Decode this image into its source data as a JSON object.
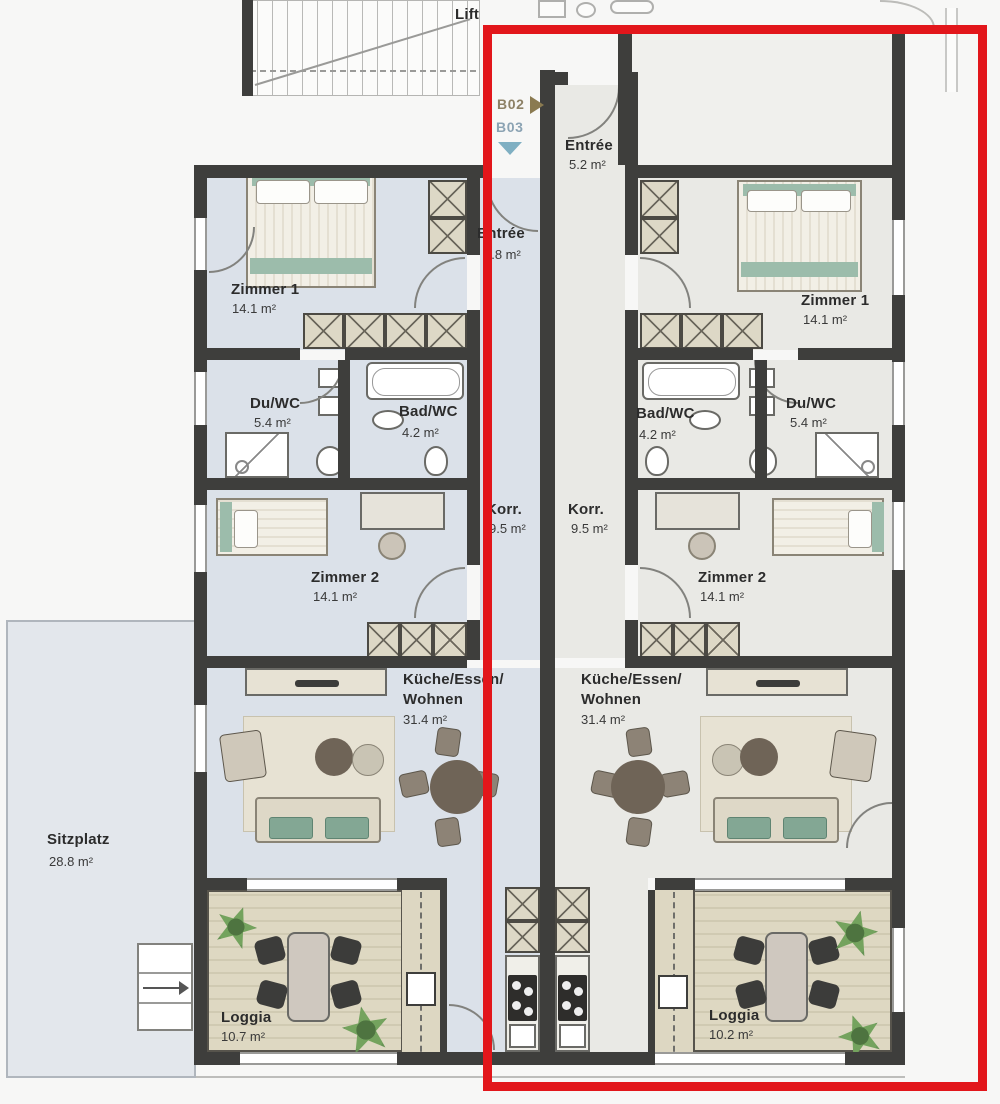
{
  "labels": {
    "lift": "Lift"
  },
  "markers": {
    "b02": "B02",
    "b03": "B03"
  },
  "outdoor": {
    "sitzplatz_name": "Sitzplatz",
    "sitzplatz_area": "28.8 m²"
  },
  "apartment_left": {
    "entree_name": "Entrée",
    "entree_area": "4.8 m²",
    "zimmer1_name": "Zimmer 1",
    "zimmer1_area": "14.1 m²",
    "du_wc_name": "Du/WC",
    "du_wc_area": "5.4 m²",
    "bad_wc_name": "Bad/WC",
    "bad_wc_area": "4.2 m²",
    "korr_name": "Korr.",
    "korr_area": "9.5 m²",
    "zimmer2_name": "Zimmer 2",
    "zimmer2_area": "14.1 m²",
    "kueche_name_line1": "Küche/Essen/",
    "kueche_name_line2": "Wohnen",
    "kueche_area": "31.4 m²",
    "loggia_name": "Loggia",
    "loggia_area": "10.7 m²"
  },
  "apartment_right": {
    "entree_name": "Entrée",
    "entree_area": "5.2 m²",
    "zimmer1_name": "Zimmer 1",
    "zimmer1_area": "14.1 m²",
    "du_wc_name": "Du/WC",
    "du_wc_area": "5.4 m²",
    "bad_wc_name": "Bad/WC",
    "bad_wc_area": "4.2 m²",
    "korr_name": "Korr.",
    "korr_area": "9.5 m²",
    "zimmer2_name": "Zimmer 2",
    "zimmer2_area": "14.1 m²",
    "kueche_name_line1": "Küche/Essen/",
    "kueche_name_line2": "Wohnen",
    "kueche_area": "31.4 m²",
    "loggia_name": "Loggia",
    "loggia_area": "10.2 m²"
  },
  "colors": {
    "highlight_red": "#e2161b",
    "floor_left_apartment": "#dbe1e9",
    "floor_right_apartment": "#e9e9e5",
    "wall": "#3e3e3c",
    "marker_b02": "#8a7a50",
    "marker_b03": "#7fafc2",
    "deck": "#d8d2bc",
    "terrace": "#e3e7ec"
  }
}
